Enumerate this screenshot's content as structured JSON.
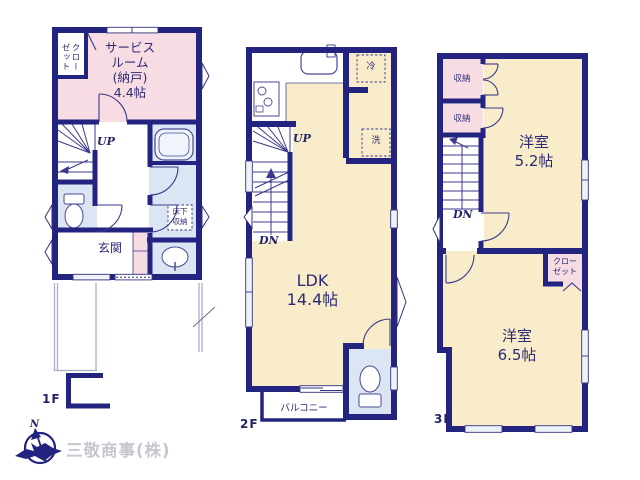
{
  "footer": {
    "company_name": "三敬商事(株)",
    "compass_north": "N"
  },
  "floor_1f": {
    "floor_label": "1F",
    "closet_label": "クロー\nゼット",
    "service_room_label": "サービス\nルーム\n(納戸)\n4.4帖",
    "stairs_up_label": "UP",
    "entrance_label": "玄関",
    "underfloor_storage_label": "床下\n収納"
  },
  "floor_2f": {
    "floor_label": "2F",
    "stairs_up_label": "UP",
    "stairs_down_label": "DN",
    "ldk_label": "LDK\n14.4帖",
    "refrigerator_label": "冷",
    "washer_label": "洗",
    "balcony_label": "バルコニー"
  },
  "floor_3f": {
    "floor_label": "3F",
    "stairs_down_label": "DN",
    "storage_top_label": "収納",
    "storage_bottom_label": "収納",
    "western_room_52_label": "洋室\n5.2帖",
    "western_room_65_label": "洋室\n6.5帖",
    "closet_label": "クロー\nゼット"
  },
  "colors": {
    "wall_navy": "#232380",
    "room_pink": "#f7dce4",
    "room_cream": "#f8ecca",
    "room_blue": "#dbe5f3",
    "line_thin": "#3a3a8c",
    "company_gray": "#c7c7d2"
  }
}
